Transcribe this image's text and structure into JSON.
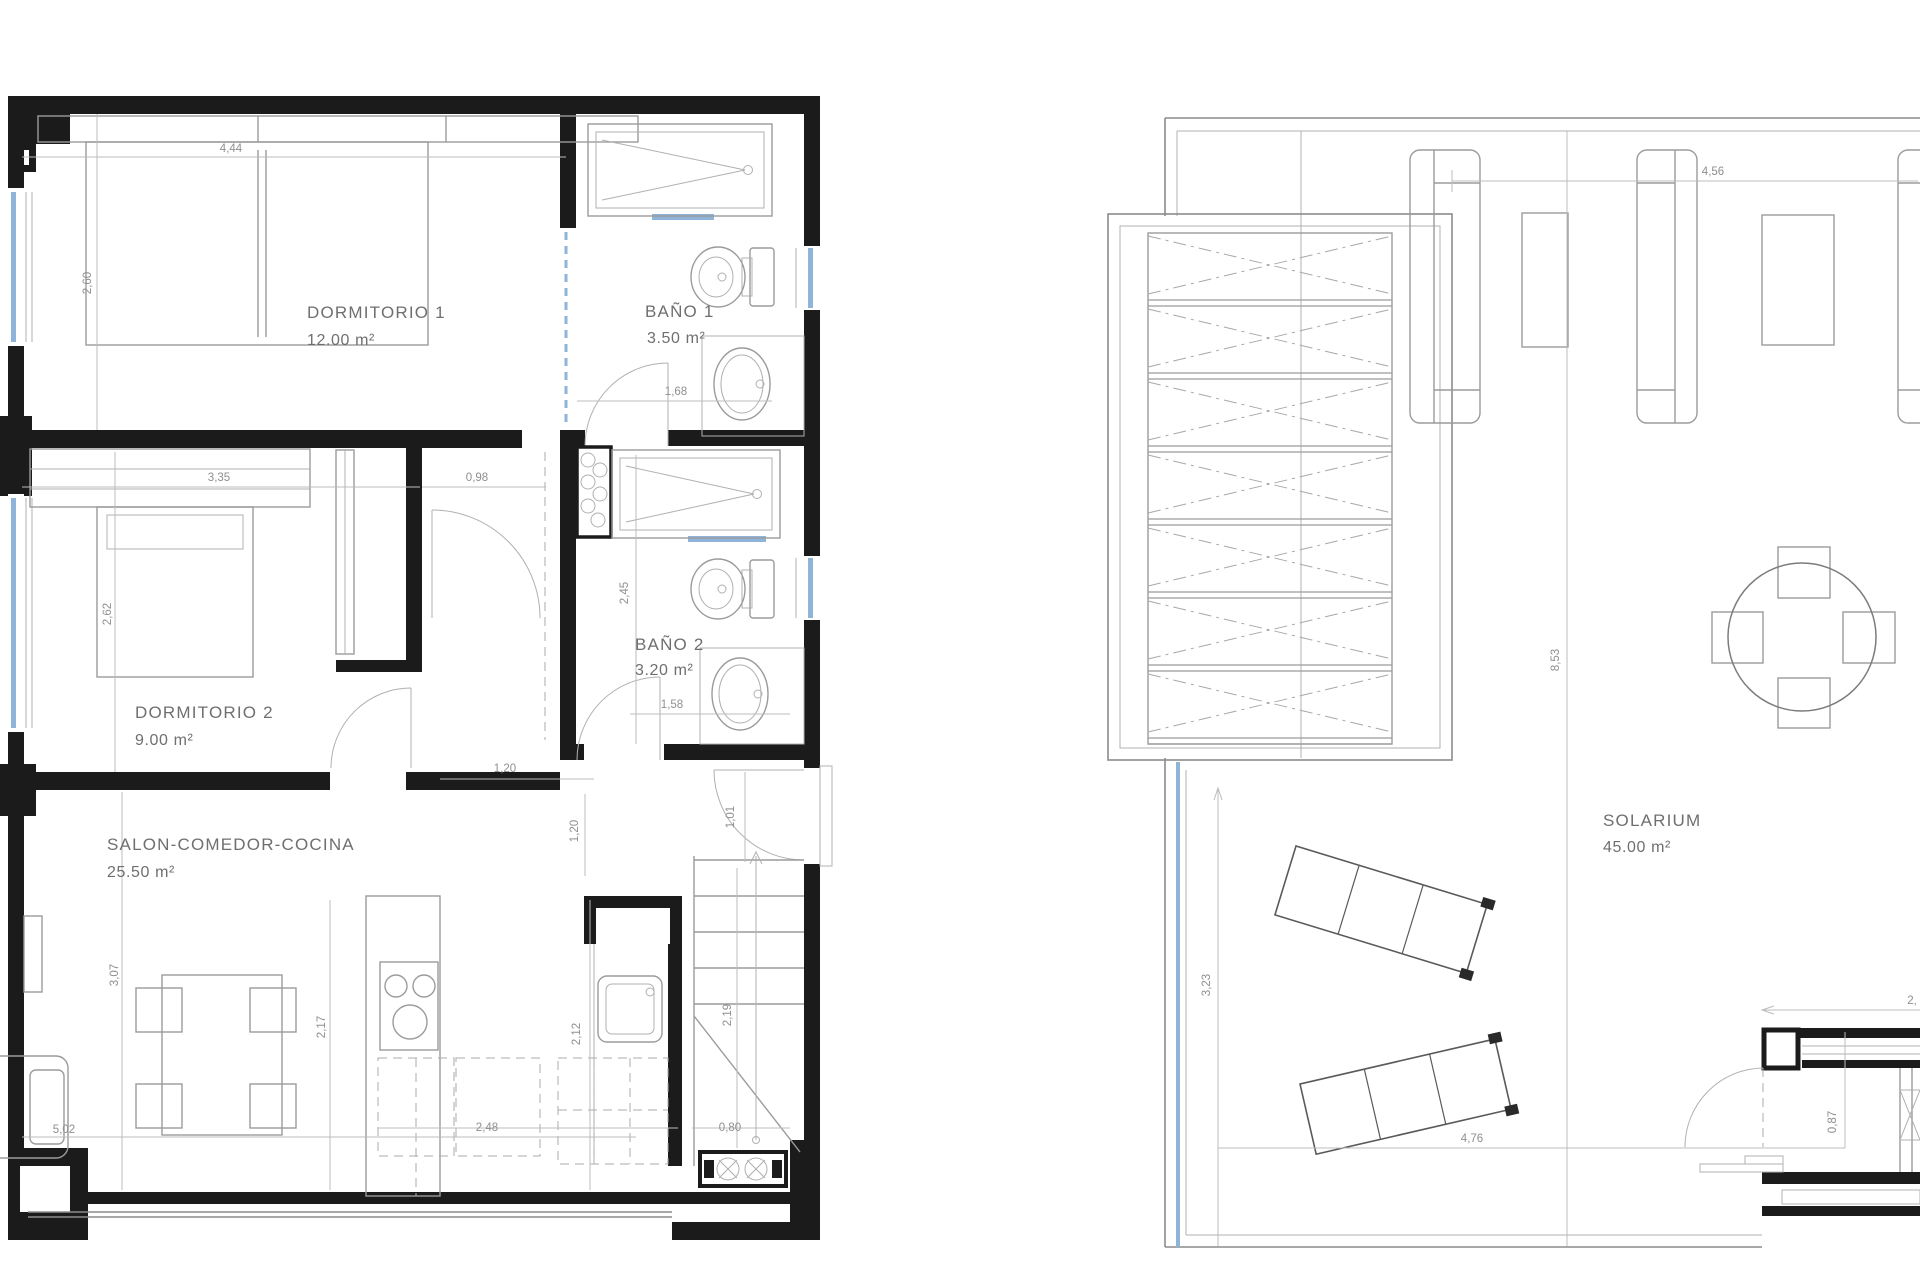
{
  "canvas": {
    "background": "#ffffff"
  },
  "colors": {
    "wall": "#1b1b1b",
    "furniture_line": "#9b9b9b",
    "dimension_line": "#bcbcbc",
    "dimension_text": "#8f8f8f",
    "label_text": "#6f6f6f",
    "glass_accent": "#8fb4d9"
  },
  "left_plan": {
    "title": "apartment floor plan",
    "rooms": [
      {
        "label": "DORMITORIO 1",
        "area": "12.00 m²"
      },
      {
        "label": "BAÑO 1",
        "area": "3.50 m²"
      },
      {
        "label": "DORMITORIO 2",
        "area": "9.00 m²"
      },
      {
        "label": "BAÑO 2",
        "area": "3.20 m²"
      },
      {
        "label": "SALON-COMEDOR-COCINA",
        "area": "25.50 m²"
      }
    ],
    "dims": {
      "dorm1_width": "4,44",
      "dorm1_depth": "2,60",
      "dorm2_width": "3,35",
      "hall_width": "0,98",
      "dorm2_depth": "2,62",
      "bano1_width": "1,68",
      "bano2_depth": "2,45",
      "bano2_width": "1,58",
      "entry_depth": "1,20",
      "entry_door": "1,01",
      "salon_depth": "3,07",
      "kitchen_depth": "2,17",
      "kitchen_pass": "1,20",
      "counter_depth": "2,12",
      "stair_depth": "2,19",
      "island_width": "2,48",
      "stair_width": "0,80",
      "salon_width": "5,02"
    }
  },
  "right_plan": {
    "title": "solarium roof plan",
    "rooms": [
      {
        "label": "SOLARIUM",
        "area": "45.00 m²"
      }
    ],
    "dims": {
      "terrace_width": "4,56",
      "terrace_depth": "8,53",
      "lower_depth": "3,23",
      "lower_width": "4,76",
      "stair_door": "0,87",
      "stair_width": "2,"
    }
  }
}
